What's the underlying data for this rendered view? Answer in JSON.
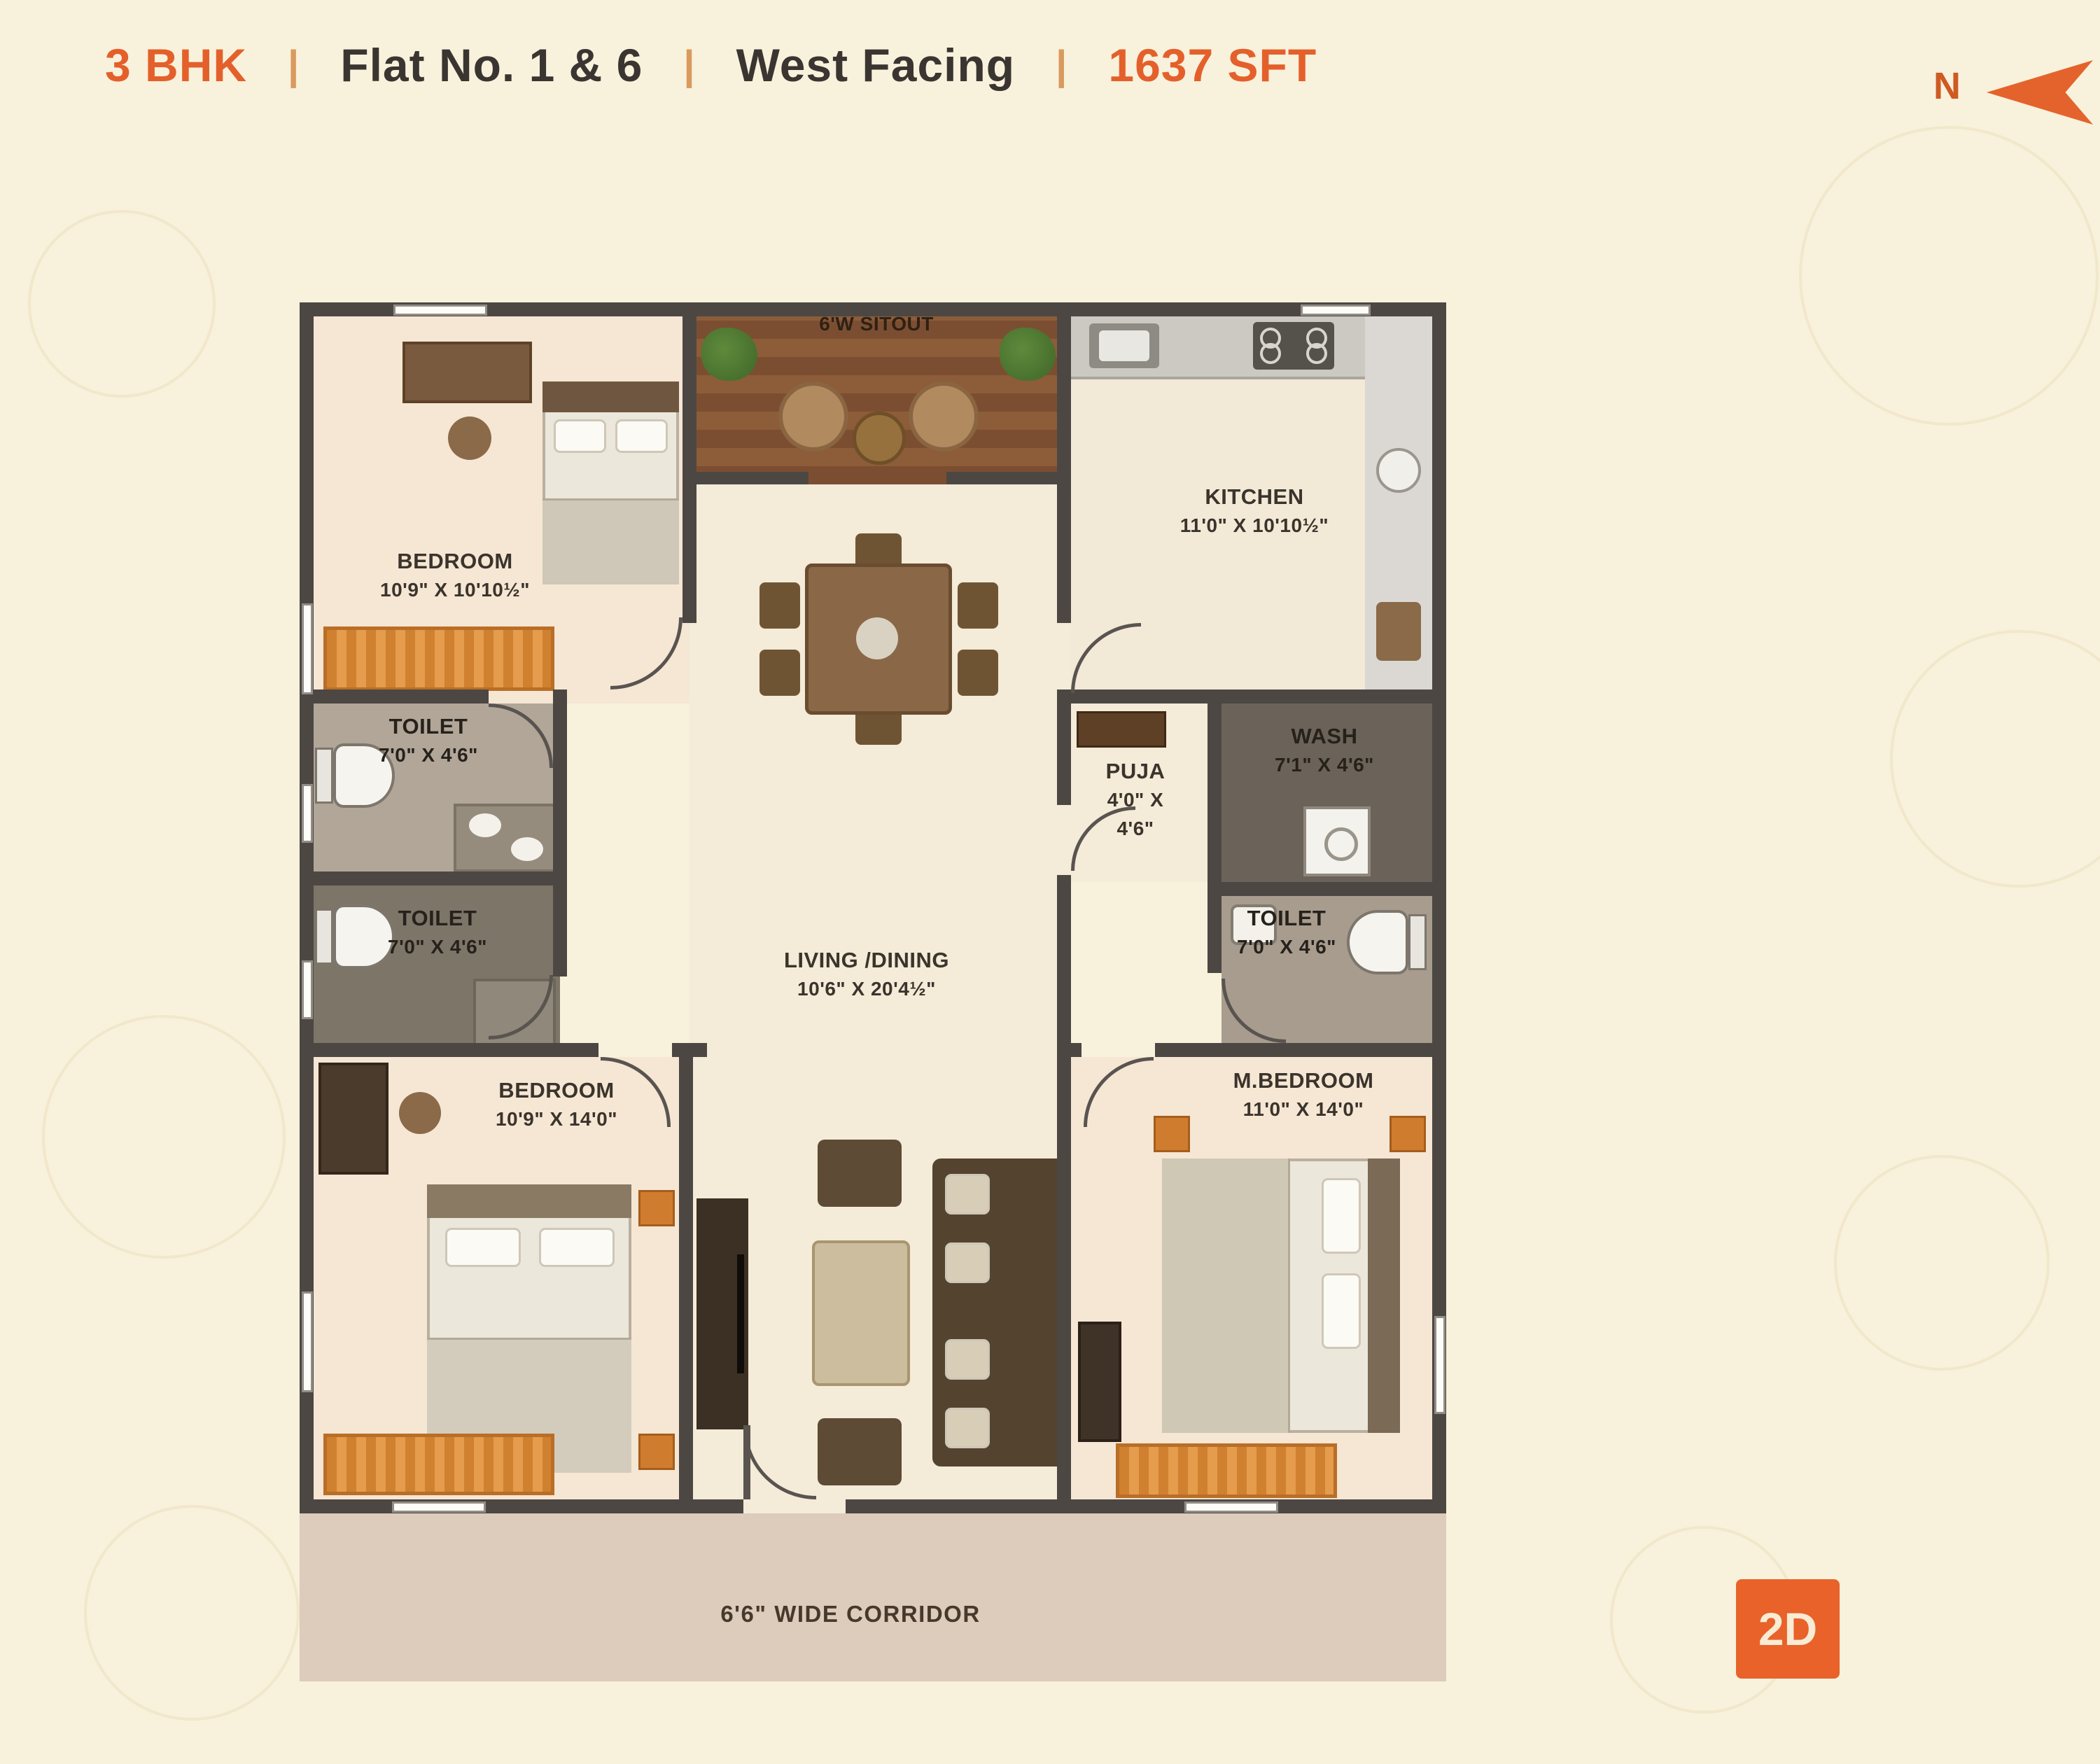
{
  "header": {
    "bhk": "3 BHK",
    "sep": "|",
    "flat": "Flat No. 1 & 6",
    "facing": "West Facing",
    "area": "1637 SFT",
    "north": "N"
  },
  "plan": {
    "sitout": {
      "label": "6'W SITOUT"
    },
    "bedroom1": {
      "name": "BEDROOM",
      "dims": "10'9\" X 10'10½\""
    },
    "kitchen": {
      "name": "KITCHEN",
      "dims": "11'0\" X 10'10½\""
    },
    "toilet1": {
      "name": "TOILET",
      "dims": "7'0\" X 4'6\""
    },
    "toilet2": {
      "name": "TOILET",
      "dims": "7'0\" X 4'6\""
    },
    "puja": {
      "name": "PUJA",
      "dims1": "4'0\" X",
      "dims2": "4'6\""
    },
    "wash": {
      "name": "WASH",
      "dims": "7'1\" X 4'6\""
    },
    "toilet3": {
      "name": "TOILET",
      "dims": "7'0\" X 4'6\""
    },
    "living": {
      "name": "LIVING /DINING",
      "dims": "10'6\" X 20'4½\""
    },
    "bedroom2": {
      "name": "BEDROOM",
      "dims": "10'9\" X 14'0\""
    },
    "mbedroom": {
      "name": "M.BEDROOM",
      "dims": "11'0\" X 14'0\""
    },
    "corridor": {
      "label": "6'6\" WIDE CORRIDOR"
    }
  },
  "badge": {
    "label": "2D"
  },
  "colors": {
    "accent_orange": "#e4632c",
    "header_text": "#3b3531",
    "wall": "#4c4743",
    "background": "#f8f1dc",
    "rug_orange": "#d0812f"
  }
}
